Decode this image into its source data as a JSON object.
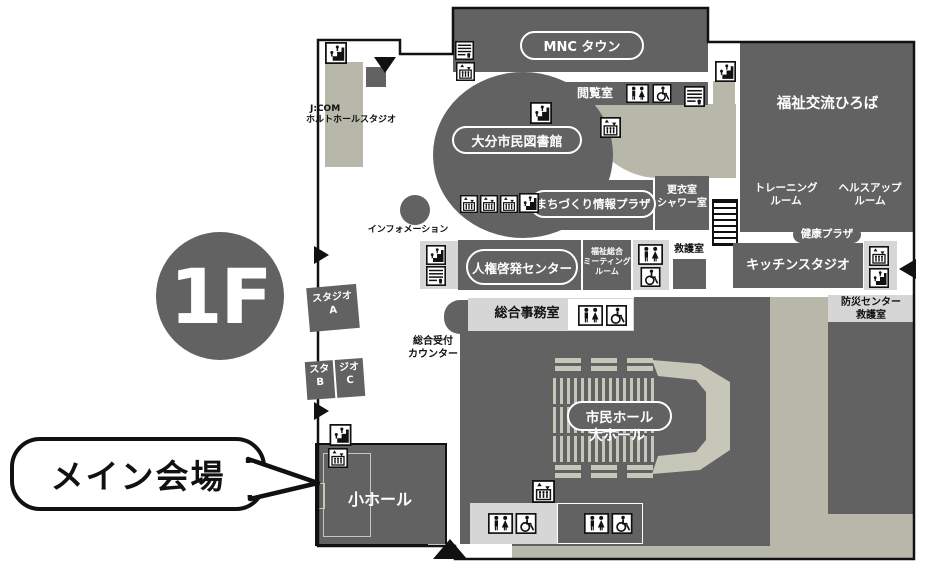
{
  "floor_badge": "1F",
  "callout": "メイン会場",
  "areas": {
    "mnc_town": "MNC タウン",
    "reading_room": "閲覧室",
    "library": "大分市民図書館",
    "jcom_line1": "J:COM",
    "jcom_line2": "ホルトホールスタジオ",
    "information": "インフォメーション",
    "machizukuri_plaza": "まちづくり情報プラザ",
    "changing_room_line1": "更衣室",
    "changing_room_line2": "シャワー室",
    "welfare_plaza": "福祉交流ひろば",
    "training_line1": "トレーニング",
    "training_line2": "ルーム",
    "healthup_line1": "ヘルスアップ",
    "healthup_line2": "ルーム",
    "jinken_center": "人権啓発センター",
    "meeting_line1": "福祉総合",
    "meeting_line2": "ミーティング",
    "meeting_line3": "ルーム",
    "first_aid": "救護室",
    "health_plaza": "健康プラザ",
    "kitchen_studio": "キッチンスタジオ",
    "bosai_line1": "防災センター",
    "bosai_line2": "救護室",
    "office": "総合事務室",
    "reception_line1": "総合受付",
    "reception_line2": "カウンター",
    "studio_a_line1": "スタジオ",
    "studio_a_line2": "A",
    "studio_b_line1": "スタ",
    "studio_b_line2": "B",
    "studio_c_line1": "ジオ",
    "studio_c_line2": "C",
    "citizen_hall": "市民ホール",
    "big_hall": "大ホール",
    "small_hall": "小ホール"
  },
  "colors": {
    "room_dark": "#626262",
    "corridor_beige": "#b7b8aa",
    "panel_light": "#d6d6d6",
    "seat_bar": "#c6c7b8",
    "outline": "#111111"
  }
}
